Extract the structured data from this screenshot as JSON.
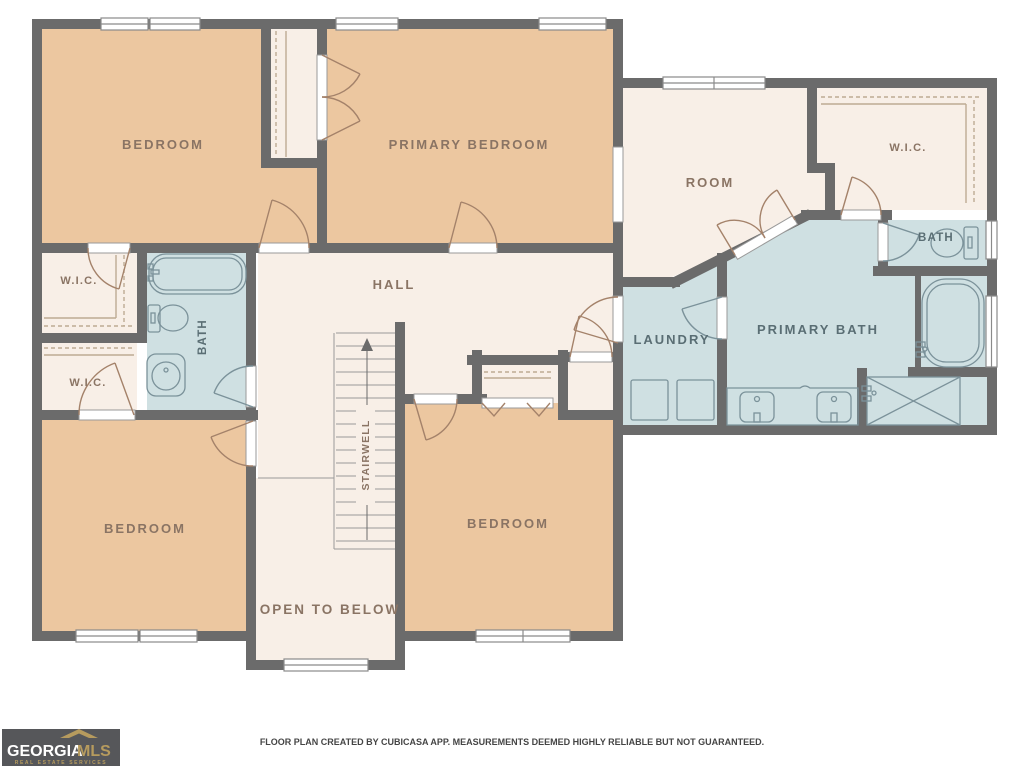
{
  "floor_plan": {
    "rooms": {
      "bedroom_top_left": "BEDROOM",
      "primary_bedroom": "PRIMARY BEDROOM",
      "room": "ROOM",
      "wic_top_right": "W.I.C.",
      "bath_right": "BATH",
      "wic_left_upper": "W.I.C.",
      "bath_left": "BATH",
      "wic_left_lower": "W.I.C.",
      "hall": "HALL",
      "laundry": "LAUNDRY",
      "primary_bath": "PRIMARY BATH",
      "stairwell": "STAIRWELL",
      "bedroom_bottom_left": "BEDROOM",
      "bedroom_bottom_right": "BEDROOM",
      "open_to_below": "OPEN TO BELOW"
    },
    "colors": {
      "wall": "#6b6b6b",
      "bedroom_fill": "#ecc7a0",
      "dry_fill": "#f8efe7",
      "wet_fill": "#cfe0e2",
      "label_warm": "#8a7464",
      "label_cool": "#5a6e74",
      "door_warm": "#a4826a",
      "door_cool": "#7b929a",
      "fixture": "#7b929a",
      "rail": "#bdab94"
    }
  },
  "footer": {
    "disclaimer": "FLOOR PLAN CREATED BY CUBICASA APP. MEASUREMENTS DEEMED HIGHLY RELIABLE BUT NOT GUARANTEED."
  },
  "logo": {
    "brand_primary": "GEORGIA",
    "brand_secondary": "MLS",
    "tagline": "REAL ESTATE SERVICES"
  }
}
